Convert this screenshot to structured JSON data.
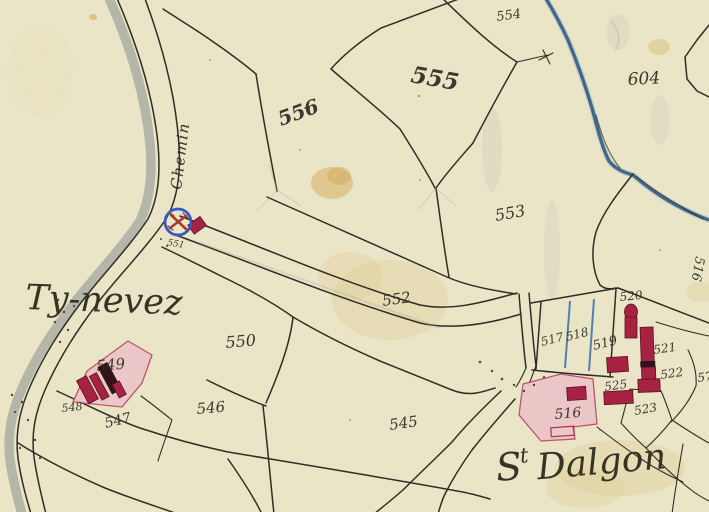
{
  "map": {
    "kind": "cadastral-map-scan",
    "road_label": "Chemin",
    "place_names": {
      "west_hamlet": "Ty-nevez",
      "east_s": "S",
      "east_t": "t",
      "east_name": "Dalgon"
    },
    "cross_label": "551",
    "parcels": {
      "p516": "516",
      "p516_ne": "516",
      "p517": "517",
      "p518": "518",
      "p519": "519",
      "p520": "520",
      "p521": "521",
      "p522": "522",
      "p523": "523",
      "p525": "525",
      "p545": "545",
      "p546": "546",
      "p547": "547",
      "p548": "548",
      "p549": "549",
      "p550": "550",
      "p552": "552",
      "p553": "553",
      "p554": "554",
      "p555": "555",
      "p556": "556",
      "p604": "604",
      "edge_partial": "57"
    },
    "colors": {
      "paper": "#ece6c8",
      "ink": "#2b2a20",
      "building_red": "#a51f3e",
      "wash_pink": "#eec5c8",
      "stream_blue": "#2d5a86",
      "cross_blue": "#2b59c9",
      "road_shadow": "#a7aaa0",
      "road_label_gold": "#8f6c26"
    }
  }
}
